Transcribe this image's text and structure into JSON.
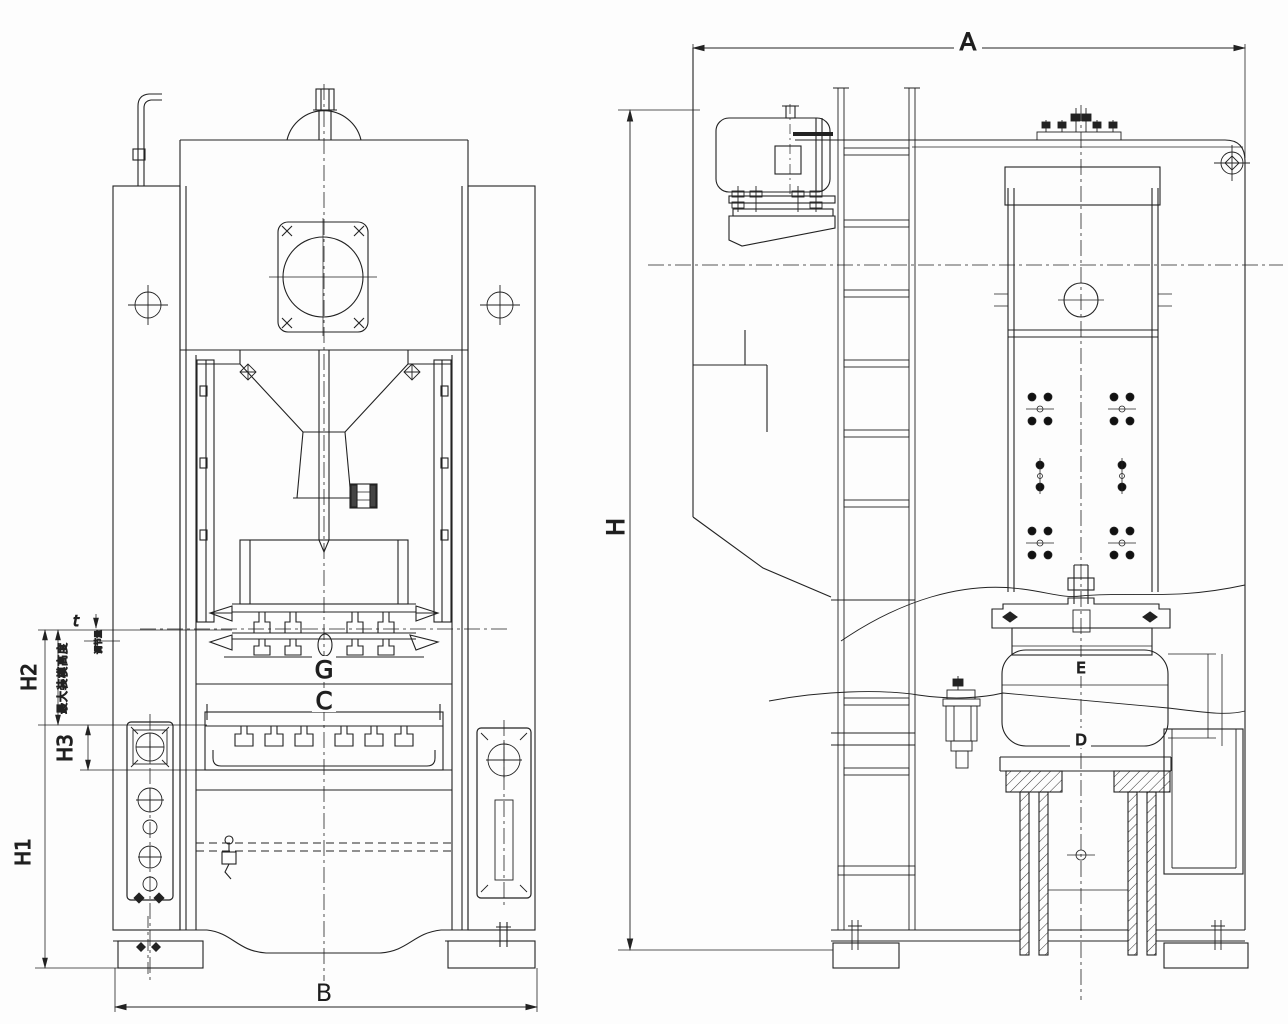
{
  "drawing": {
    "kind": "press-machine outline drawing, front and side elevation",
    "colors": {
      "line": "#222222",
      "background": "#fdfdfd"
    },
    "front_view": {
      "labels": {
        "t": "t",
        "adjust_note": "调节量",
        "max_die_height": "最大装模高度",
        "h1": "H1",
        "h2": "H2",
        "h3": "H3",
        "g": "G",
        "c": "C",
        "b": "B"
      }
    },
    "side_view": {
      "labels": {
        "a": "A",
        "h": "H",
        "e": "E",
        "d": "D"
      }
    }
  }
}
